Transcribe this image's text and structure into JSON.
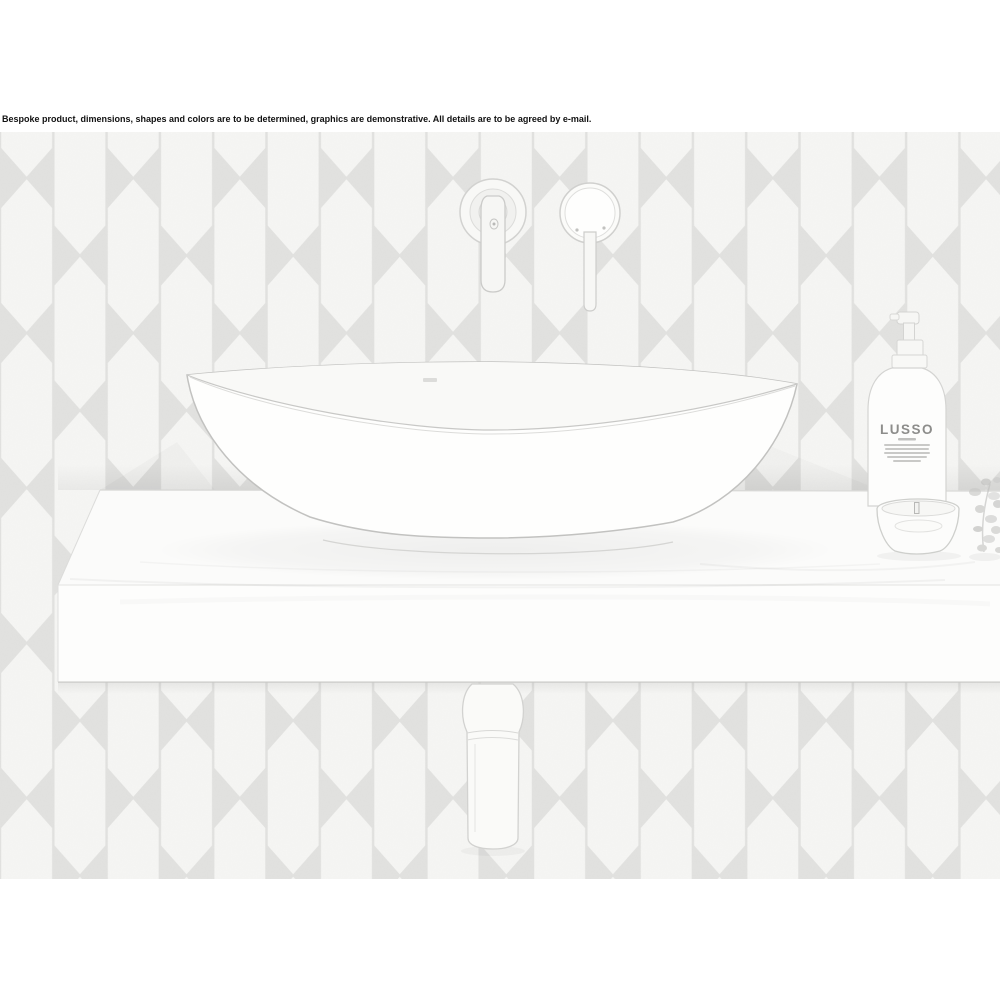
{
  "disclaimer": "Bespoke product, dimensions, shapes and colors are to be determined, graphics are demonstrative. All details are to be agreed by e-mail.",
  "soap_bottle": {
    "brand": "LUSSO"
  },
  "colors": {
    "page_background": "#ffffff",
    "disclaimer_text": "#111111",
    "tile_fill": "#f6f6f4",
    "tile_grout": "#e2e2e0",
    "sketch_line": "#c9c9c7",
    "surface_white": "#fcfcfb"
  }
}
